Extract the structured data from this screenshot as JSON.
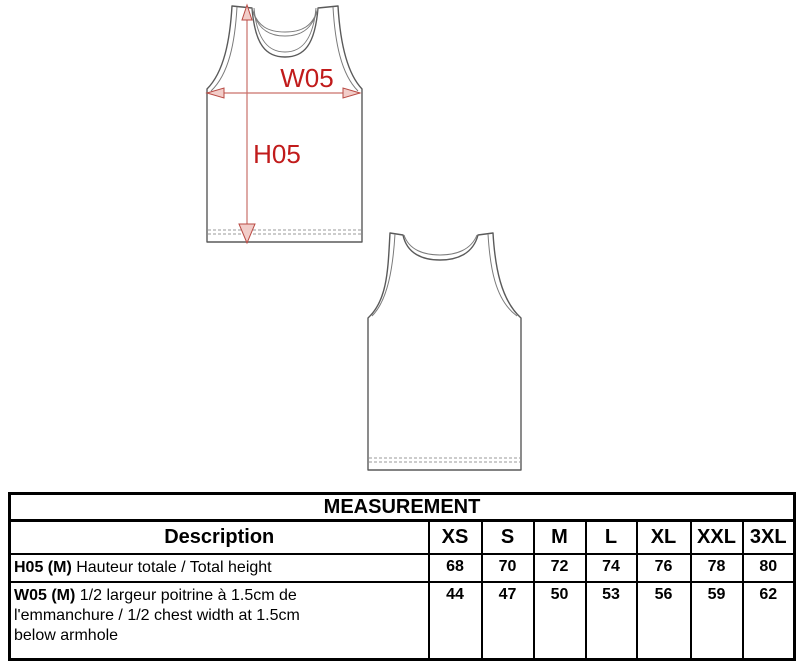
{
  "front_view": {
    "width_label": "W05",
    "height_label": "H05"
  },
  "colors": {
    "dimension_text_red": "#c11b1b",
    "dimension_line_red": "#c9706a",
    "outline_gray": "#5a5a5a",
    "table_border": "#000000"
  },
  "table": {
    "title": "MEASUREMENT",
    "description_header": "Description",
    "size_headers": [
      "XS",
      "S",
      "M",
      "L",
      "XL",
      "XXL",
      "3XL"
    ],
    "rows": [
      {
        "code": "H05 (M)",
        "text": " Hauteur totale / Total height",
        "values": [
          "68",
          "70",
          "72",
          "74",
          "76",
          "78",
          "80"
        ]
      },
      {
        "code": "W05 (M)",
        "text": " 1/2 largeur poitrine à 1.5cm de\nl'emmanchure / 1/2 chest width at 1.5cm\nbelow armhole",
        "values": [
          "44",
          "47",
          "50",
          "53",
          "56",
          "59",
          "62"
        ]
      }
    ]
  }
}
